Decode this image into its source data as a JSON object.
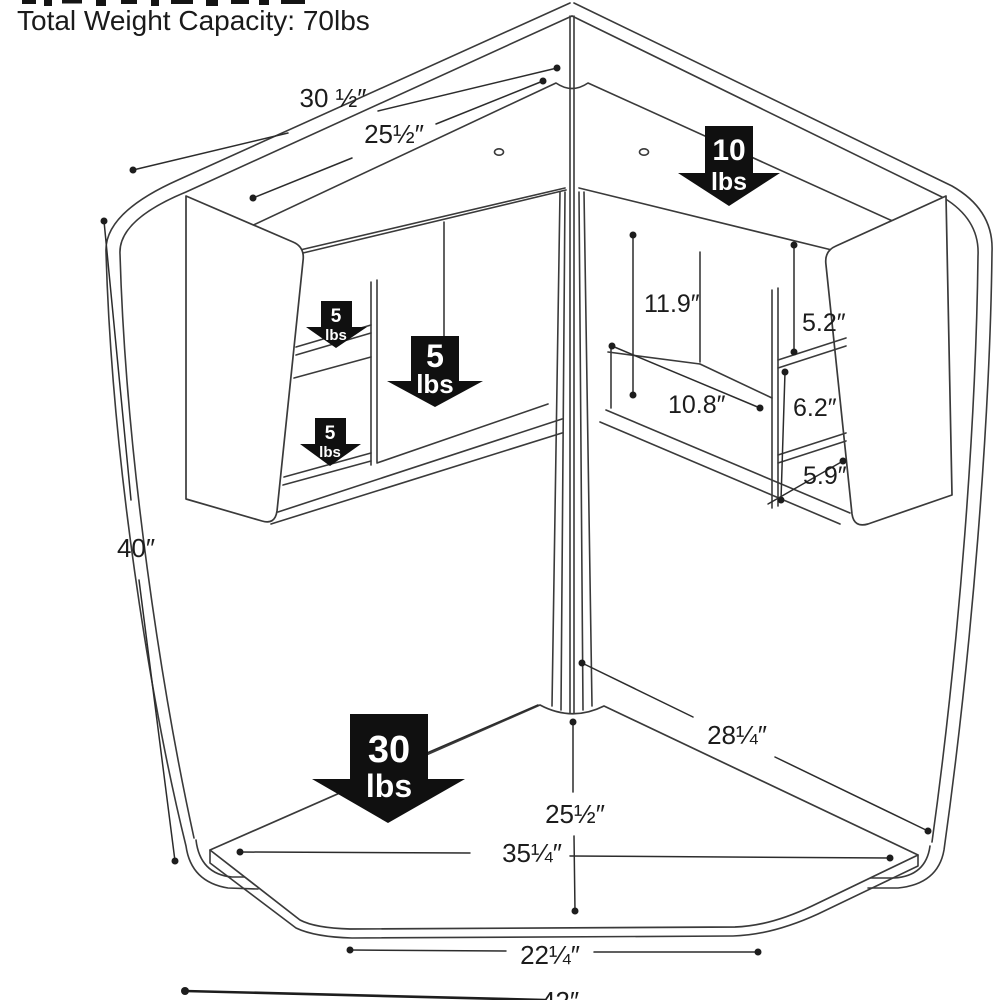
{
  "header": {
    "capacity_note": "Total Weight Capacity: 70lbs"
  },
  "diagram": {
    "subject": "corner desk with hutch dimension drawing",
    "line_color": "#3a3a3a",
    "arrow_color": "#101010",
    "dimensions": [
      {
        "id": "hutch-top-outer-width",
        "label": "30 ½″"
      },
      {
        "id": "hutch-top-inner-width",
        "label": "25½″"
      },
      {
        "id": "side-height",
        "label": "40″"
      },
      {
        "id": "right-compartment-height",
        "label": "11.9″"
      },
      {
        "id": "right-cubby-top-height",
        "label": "5.2″"
      },
      {
        "id": "right-compartment-width",
        "label": "10.8″"
      },
      {
        "id": "right-cubby-middle-height",
        "label": "6.2″"
      },
      {
        "id": "right-cubby-bottom-depth",
        "label": "5.9″"
      },
      {
        "id": "desk-back-edge-depth",
        "label": "28¼″"
      },
      {
        "id": "desk-depth",
        "label": "25½″"
      },
      {
        "id": "desk-width",
        "label": "35¼″"
      },
      {
        "id": "desk-front-edge-width",
        "label": "22¼″"
      },
      {
        "id": "overall-width",
        "label": "42″"
      }
    ],
    "weight_arrows": [
      {
        "id": "hutch-top",
        "value": "10",
        "unit": "lbs"
      },
      {
        "id": "left-cubby-top",
        "value": "5",
        "unit": "lbs"
      },
      {
        "id": "left-compartment",
        "value": "5",
        "unit": "lbs"
      },
      {
        "id": "left-cubby-bottom",
        "value": "5",
        "unit": "lbs"
      },
      {
        "id": "desk-surface",
        "value": "30",
        "unit": "lbs"
      }
    ]
  }
}
